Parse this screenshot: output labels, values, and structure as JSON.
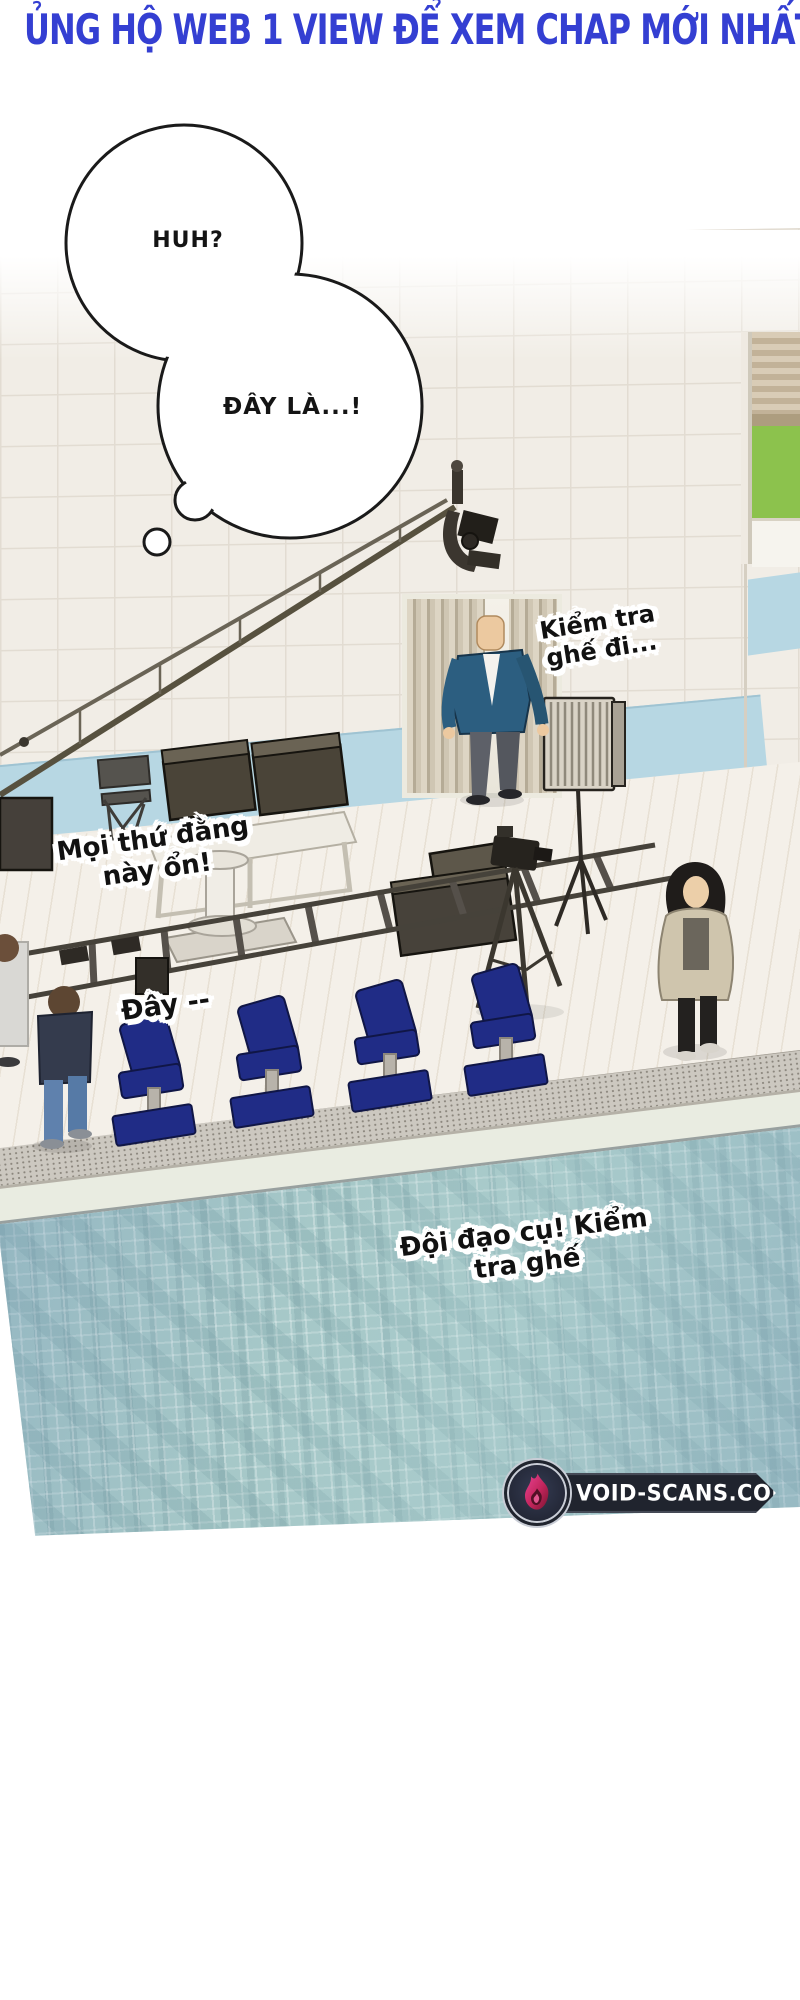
{
  "header": {
    "text": "ỦNG HỘ WEB 1 VIEW ĐỂ XEM CHAP MỚI NHẤT",
    "color": "#343fd2"
  },
  "thought_bubbles": [
    {
      "text": "HUH?"
    },
    {
      "text": "ĐÂY LÀ...!"
    }
  ],
  "dialogues": [
    {
      "text": "Kiểm tra\nghế đi..."
    },
    {
      "text": "Mọi thứ đằng\nnày ổn!"
    },
    {
      "text": "Đây --"
    },
    {
      "text": "Đội đạo cụ! Kiểm\ntra ghế"
    }
  ],
  "watermark": {
    "site": "VOID-SCANS.COM",
    "logo_icon": "flame-icon",
    "banner_color": "#20242e",
    "flame_colors": [
      "#e84393",
      "#c2255c",
      "#7a1430"
    ]
  },
  "scene_colors": {
    "wall_tile": "#f1ede6",
    "wall_band_blue": "#b7d7e3",
    "floor": "#f4f0e9",
    "curtain": "#cfc6b3",
    "water_teal": "#a6c8c8",
    "chair_navy": "#202c86",
    "blazer_blue": "#2c5e80",
    "coat_beige": "#cfc5ad",
    "window_green": "#8cc24d"
  }
}
